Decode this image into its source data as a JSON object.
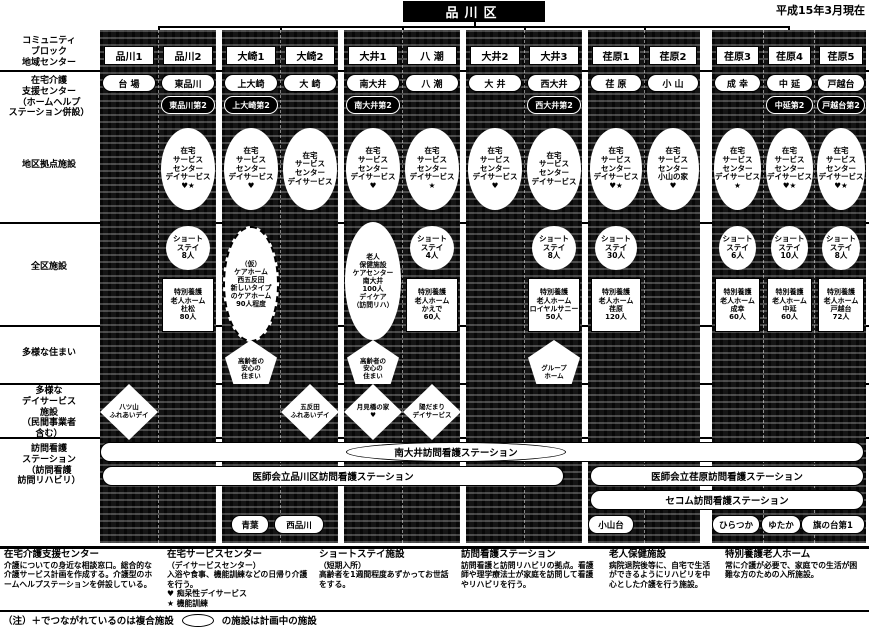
{
  "header": {
    "title": "品川区",
    "date": "平成15年3月現在"
  },
  "row_labels": [
    "コミュニティ\nブロック\n地域センター",
    "在宅介護\n支援センター\n（ホームヘルプ\nステーション併設）",
    "地区拠点施設",
    "全区施設",
    "多様な住まい",
    "多様な\nデイサービス\n施設\n（民間事業者\n含む）",
    "訪問看護\nステーション\n（訪問看護\n訪問リハビリ）"
  ],
  "columns": [
    {
      "header": "品川1",
      "support1": "台 場",
      "day_diamond": "八ツ山\nふれあいデイ"
    },
    {
      "header": "品川2",
      "support1": "東品川",
      "support2": "東品川第2",
      "service": "在宅\nサービス\nセンター\nデイサービス\n♥★",
      "shortstay": "ショート\nステイ\n8人",
      "tokuyo": "特別養護\n老人ホーム\n杜松\n80人"
    },
    {
      "header": "大崎1",
      "support1": "上大崎",
      "support2": "上大崎第2",
      "service": "在宅\nサービス\nセンター\nデイサービス\n♥",
      "planned": "（仮）\nケアホーム\n西五反田\n新しいタイプ\nのケアホーム\n90人程度",
      "housing": "高齢者の\n安心の\n住まい"
    },
    {
      "header": "大崎2",
      "support1": "大 崎",
      "service": "在宅\nサービス\nセンター\nデイサービス",
      "day_diamond": "五反田\nふれあいデイ"
    },
    {
      "header": "大井1",
      "support1": "南大井",
      "support2": "南大井第2",
      "service": "在宅\nサービス\nセンター\nデイサービス\n♥",
      "rouken": "老人\n保健施設\nケアセンター\n南大井\n100人\nデイケア\n（訪問リハ）",
      "housing": "高齢者の\n安心の\n住まい",
      "day_diamond": "月見橋の家\n♥"
    },
    {
      "header": "八 潮",
      "support1": "八 潮",
      "service": "在宅\nサービス\nセンター\nデイサービス\n★",
      "shortstay": "ショート\nステイ\n4人",
      "tokuyo": "特別養護\n老人ホーム\nかえで\n60人",
      "day_diamond": "陽だまり\nデイサービス"
    },
    {
      "header": "大井2",
      "support1": "大 井",
      "service": "在宅\nサービス\nセンター\nデイサービス\n♥"
    },
    {
      "header": "大井3",
      "support1": "西大井",
      "support2": "西大井第2",
      "service": "在宅\nサービス\nセンター\nデイサービス",
      "shortstay": "ショート\nステイ\n8人",
      "tokuyo": "特別養護\n老人ホーム\nロイヤルサニー\n50人",
      "housing": "グループ\nホーム"
    },
    {
      "header": "荏原1",
      "support1": "荏 原",
      "service": "在宅\nサービス\nセンター\nデイサービス\n♥★",
      "shortstay": "ショート\nステイ\n30人",
      "tokuyo": "特別養護\n老人ホーム\n荏原\n120人"
    },
    {
      "header": "荏原2",
      "support1": "小 山",
      "service": "在宅\nサービス\nセンター\n小山の家\n♥"
    },
    {
      "header": "荏原3",
      "support1": "成 幸",
      "service": "在宅\nサービス\nセンター\nデイサービス\n★",
      "shortstay": "ショート\nステイ\n6人",
      "tokuyo": "特別養護\n老人ホーム\n成幸\n60人"
    },
    {
      "header": "荏原4",
      "support1": "中 延",
      "support2": "中延第2",
      "service": "在宅\nサービス\nセンター\nデイサービス\n♥★",
      "shortstay": "ショート\nステイ\n10人",
      "tokuyo": "特別養護\n老人ホーム\n中延\n60人"
    },
    {
      "header": "荏原5",
      "support1": "戸越台",
      "support2": "戸越台第2",
      "service": "在宅\nサービス\nセンター\nデイサービス\n♥★",
      "shortstay": "ショート\nステイ\n8人",
      "tokuyo": "特別養護\n老人ホーム\n戸越台\n72人"
    }
  ],
  "nurse": {
    "row1_oval": "南大井訪問看護ステーション",
    "row2_left": "医師会立品川区訪問看護ステーション",
    "row2_right": "医師会立荏原訪問看護ステーション",
    "row3_right": "セコム訪問看護ステーション",
    "ovals": [
      "青葉",
      "西品川",
      "小山台",
      "ひらつか",
      "ゆたか",
      "旗の台第1"
    ]
  },
  "legend": {
    "items": [
      {
        "title": "在宅介護支援センター",
        "body": "介護についての身近な相談窓口。総合的な介護サービス計画を作成する。介護型のホームヘルプステーションを併設している。"
      },
      {
        "title": "在宅サービスセンター",
        "body": "（デイサービスセンター）\n入浴や食事、機能訓練などの日帰り介護を行う。\n♥ 痴呆性デイサービス\n★ 機能訓練"
      },
      {
        "title": "ショートステイ施設",
        "body": "（短期入所）\n高齢者を1週間程度あずかってお世話をする。"
      },
      {
        "title": "訪問看護ステーション",
        "body": "訪問看護と訪問リハビリの拠点。看護師や理学療法士が家庭を訪問して看護やリハビリを行う。"
      },
      {
        "title": "老人保健施設",
        "body": "病院退院後等に、自宅で生活ができるようにリハビリを中心とした介護を行う施設。"
      },
      {
        "title": "特別養護老人ホーム",
        "body": "常に介護が必要で、家庭での生活が困難な方のための入所施設。"
      }
    ],
    "note_plus": "（注）＋でつながれているのは複合施設",
    "note_oval": "の施設は計画中の施設"
  }
}
